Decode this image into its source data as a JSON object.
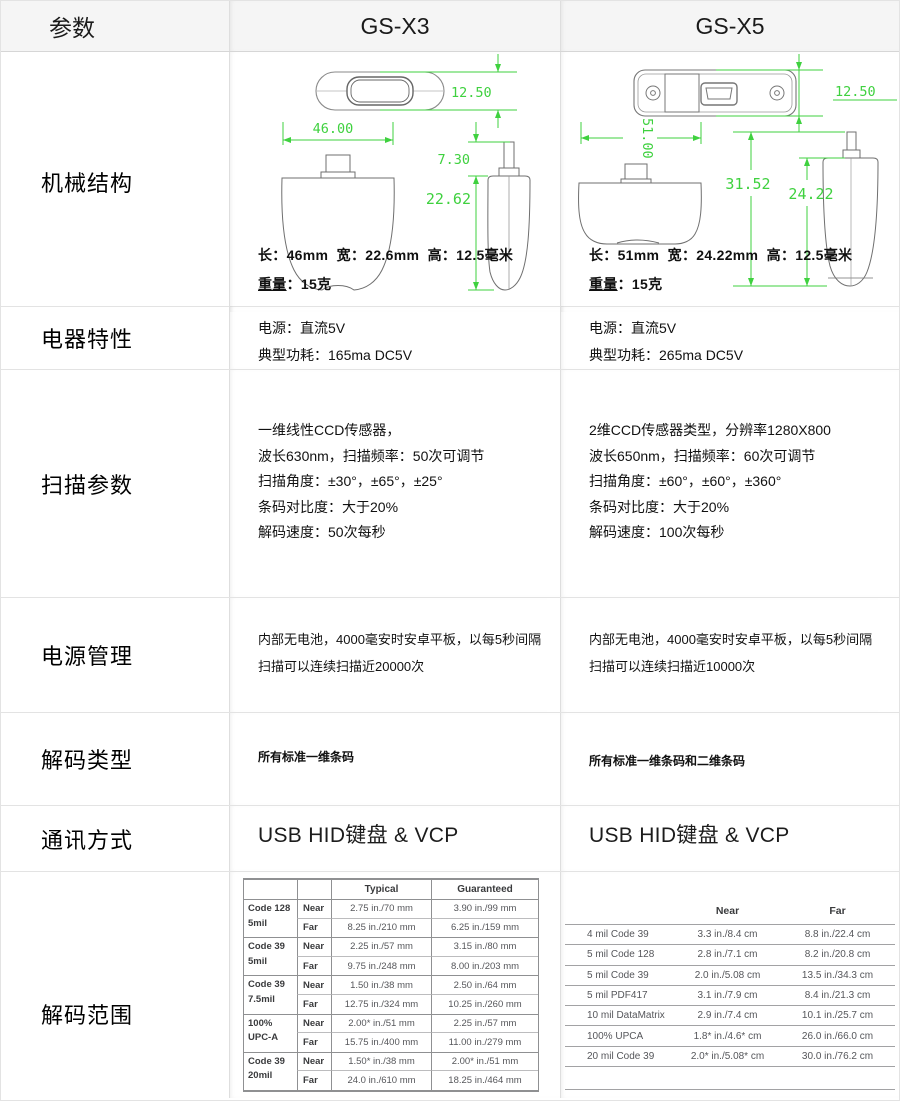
{
  "colors": {
    "dimension_green": "#3fd13f",
    "header_bg": "#f5f5f5"
  },
  "header": {
    "param": "参数",
    "x3": "GS-X3",
    "x5": "GS-X5"
  },
  "mechanical": {
    "label": "机械结构",
    "x3": {
      "dim_height": "12.50",
      "dim_length": "46.00",
      "dim_conn": "7.30",
      "dim_body": "22.62",
      "caption": "长：46mm  宽：22.6mm  高：12.5毫米",
      "weight_label": "重量",
      "weight_rest": "：15克"
    },
    "x5": {
      "dim_height": "12.50",
      "dim_length": "51.00",
      "dim_total": "31.52",
      "dim_body": "24.22",
      "caption": "长：51mm  宽：24.22mm  高：12.5毫米",
      "weight_label": "重量",
      "weight_rest": "：15克"
    }
  },
  "electrical": {
    "label": "电器特性",
    "x3": {
      "line1": "电源：直流5V",
      "line2": "典型功耗：165ma DC5V"
    },
    "x5": {
      "line1": "电源：直流5V",
      "line2": "典型功耗：265ma DC5V"
    }
  },
  "scanning": {
    "label": "扫描参数",
    "x3": [
      "一维线性CCD传感器，",
      "波长630nm，扫描频率：50次可调节",
      "扫描角度：±30°，±65°，±25°",
      "条码对比度：大于20%",
      "解码速度：50次每秒"
    ],
    "x5": [
      "2维CCD传感器类型，分辨率1280X800",
      "波长650nm，扫描频率：60次可调节",
      "扫描角度：±60°，±60°，±360°",
      "条码对比度：大于20%",
      "解码速度：100次每秒"
    ]
  },
  "power": {
    "label": "电源管理",
    "x3": "内部无电池，4000毫安时安卓平板，以每5秒间隔扫描可以连续扫描近20000次",
    "x5": "内部无电池，4000毫安时安卓平板，以每5秒间隔扫描可以连续扫描近10000次"
  },
  "decode_type": {
    "label": "解码类型",
    "x3": "所有标准一维条码",
    "x5": "所有标准一维条码和二维条码"
  },
  "comm": {
    "label": "通讯方式",
    "x3": "USB HID键盘 & VCP",
    "x5": "USB HID键盘 & VCP"
  },
  "range": {
    "label": "解码范围",
    "x3_table": {
      "typical_header": "Typical",
      "guaranteed_header": "Guaranteed",
      "near_label": "Near",
      "far_label": "Far",
      "groups": [
        {
          "name": "Code 128",
          "size": "5mil",
          "nt": "2.75 in./70 mm",
          "ng": "3.90 in./99 mm",
          "ft": "8.25 in./210 mm",
          "fg": "6.25 in./159 mm"
        },
        {
          "name": "Code 39",
          "size": "5mil",
          "nt": "2.25 in./57 mm",
          "ng": "3.15 in./80 mm",
          "ft": "9.75 in./248 mm",
          "fg": "8.00 in./203 mm"
        },
        {
          "name": "Code 39",
          "size": "7.5mil",
          "nt": "1.50 in./38 mm",
          "ng": "2.50 in./64 mm",
          "ft": "12.75 in./324 mm",
          "fg": "10.25 in./260 mm"
        },
        {
          "name": "100%",
          "size": "UPC-A",
          "nt": "2.00* in./51 mm",
          "ng": "2.25 in./57 mm",
          "ft": "15.75 in./400 mm",
          "fg": "11.00 in./279 mm"
        },
        {
          "name": "Code 39",
          "size": "20mil",
          "nt": "1.50* in./38 mm",
          "ng": "2.00* in./51 mm",
          "ft": "24.0 in./610 mm",
          "fg": "18.25 in./464 mm"
        }
      ]
    },
    "x5_table": {
      "near_header": "Near",
      "far_header": "Far",
      "rows": [
        {
          "label": "4 mil Code 39",
          "near": "3.3 in./8.4 cm",
          "far": "8.8 in./22.4 cm"
        },
        {
          "label": "5 mil Code 128",
          "near": "2.8 in./7.1 cm",
          "far": "8.2 in./20.8 cm"
        },
        {
          "label": "5 mil Code 39",
          "near": "2.0 in./5.08 cm",
          "far": "13.5 in./34.3 cm"
        },
        {
          "label": "5 mil PDF417",
          "near": "3.1 in./7.9 cm",
          "far": "8.4 in./21.3 cm"
        },
        {
          "label": "10 mil DataMatrix",
          "near": "2.9 in./7.4 cm",
          "far": "10.1 in./25.7 cm"
        },
        {
          "label": "100% UPCA",
          "near": "1.8* in./4.6* cm",
          "far": "26.0 in./66.0 cm"
        },
        {
          "label": "20 mil Code 39",
          "near": "2.0* in./5.08* cm",
          "far": "30.0 in./76.2 cm"
        }
      ]
    }
  }
}
